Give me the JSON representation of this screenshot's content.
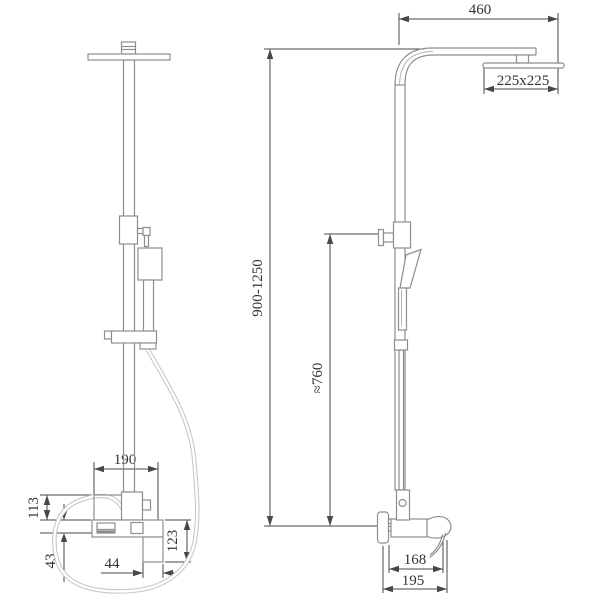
{
  "meta": {
    "background_color": "#ffffff",
    "outline_color": "#8e8e8e",
    "dimension_color": "#474747",
    "hose_color": "#c6c6c6"
  },
  "dimensions": {
    "arm_reach": "460",
    "head_size": "225x225",
    "column_height_range": "900-1250",
    "hose_drop": "≈760",
    "spout_to_handle": "190",
    "upper_height": "113",
    "lower_height": "43",
    "outlet_offset": "44",
    "drop_length": "123",
    "spout_tip_reach": "168",
    "spout_total_reach": "195"
  }
}
